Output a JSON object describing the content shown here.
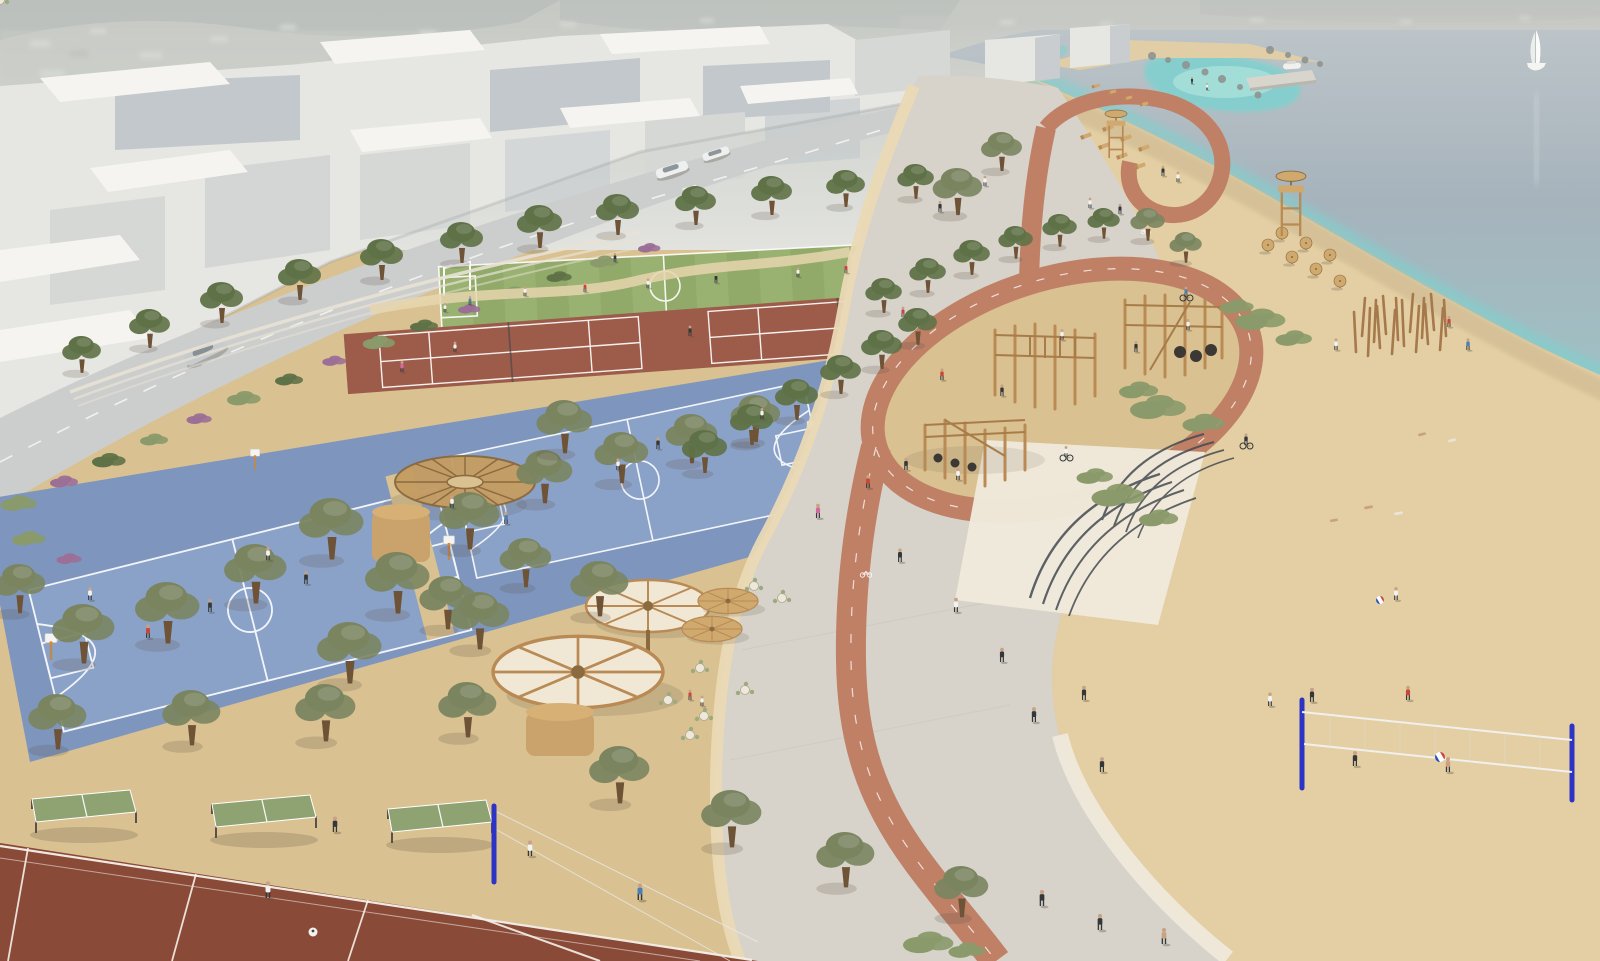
{
  "meta": {
    "type": "architectural-aerial-render",
    "description": "Aerial 3D rendering of a seafront sports park with promenade, cycle path and beach",
    "canvas": {
      "width": 1600,
      "height": 961
    },
    "visible_text": "none"
  },
  "palette": {
    "haze": "#c5c8c3",
    "hazeLight": "#e2e3df",
    "mountain": "#b2b7b5",
    "cityBlockTop": "#f5f4f0",
    "cityBlockFace": "#e6e6e2",
    "cityBlockShade": "#c2c8cb",
    "cityBlockMid": "#d6d8d6",
    "road": "#cccecd",
    "roadLine": "#ffffff",
    "seaHorizon": "#bcc4c8",
    "seaDeep": "#a6b3bc",
    "seaShallow": "#9fc0c4",
    "turquoise": "#7ed1cf",
    "turquoiseLight": "#b8e8e0",
    "foam": "#f2f6f1",
    "sandBeach": "#e4cfa4",
    "sandWet": "#d2bd94",
    "sandPark": "#d9c191",
    "promenade": "#d7d3ca",
    "promenadeCream": "#ead9b4",
    "stepsConcrete": "#efe9db",
    "stepEdge": "#454a50",
    "bikePath": "#bf8066",
    "fieldGreen": "#92aa69",
    "fieldGreenLight": "#a0b778",
    "tennisClay": "#9d5b4a",
    "clayCourt": "#8a4a38",
    "basketballBlue": "#7e96be",
    "basketballBlueLight": "#8fa5ca",
    "tableTennisGreen": "#8ea371",
    "netPostBlue": "#2b34c4",
    "courtLine": "#ffffff",
    "woodLight": "#cfa96e",
    "woodMid": "#b98a54",
    "woodDark": "#8a6a3e",
    "canopyCream": "#f0e8d4",
    "oliveFoliage": "#7a8560",
    "pineFoliage": "#5f7247",
    "shrubGreen": "#8a9a6a",
    "flowerPurple": "#9c6f96",
    "trunk": "#6e5336",
    "skin": "#c9a183",
    "figureDark": "#35383b",
    "accentRed": "#c8473a",
    "accentPink": "#d46a9a",
    "accentTeal": "#4a7fb5",
    "figureWhite": "#f2f2f0",
    "shadow": "#5a5244"
  },
  "scene": {
    "background": {
      "hazy_city_skyline": true,
      "mountain_silhouettes": true
    },
    "sea": {
      "sailboat": 1,
      "motor_boat_at_jetty": 1,
      "jetty": 1,
      "rocky_breakwater": true,
      "turquoise_lagoon": true,
      "foam_line": true
    },
    "beach": {
      "sun_loungers": 11,
      "wooden_parasols": 7,
      "lifeguard_towers": 2,
      "timber_pole_cluster": 16,
      "volleyball_nets": 1,
      "volleyball_players": 5,
      "beach_balls": 2,
      "sunbathers": 5,
      "dune_shrubs": 4
    },
    "promenade": {
      "surface": "light concrete",
      "cream_edge_band": true,
      "terraced_step_groups": 2,
      "cycle_path": {
        "loops_playground": true,
        "white_bike_markings": 2,
        "cyclists": 3
      }
    },
    "park": {
      "soccer_field": {
        "count": 1,
        "goals": 2,
        "players": 6
      },
      "tennis_courts": {
        "count": 2,
        "nets": 2
      },
      "basketball_courts": {
        "count": 2,
        "hoops": 5
      },
      "clay_courts": {
        "count": 3
      },
      "table_tennis_tables": {
        "count": 3
      },
      "park_volleyball_posts": {
        "count": 1
      },
      "playground_climbing_structures": {
        "count": 3,
        "tyre_elements": 6
      },
      "cafe": {
        "round_canopy_umbrellas": 4,
        "timber_wheel_canopy": 1,
        "kiosks": 2,
        "table_chair_sets": 8
      },
      "street_trees": 53
    },
    "city": {
      "white_massing_blocks": true,
      "street": {
        "cars": 3,
        "dashed_centerline": true
      }
    },
    "people_total_estimate": 72
  }
}
